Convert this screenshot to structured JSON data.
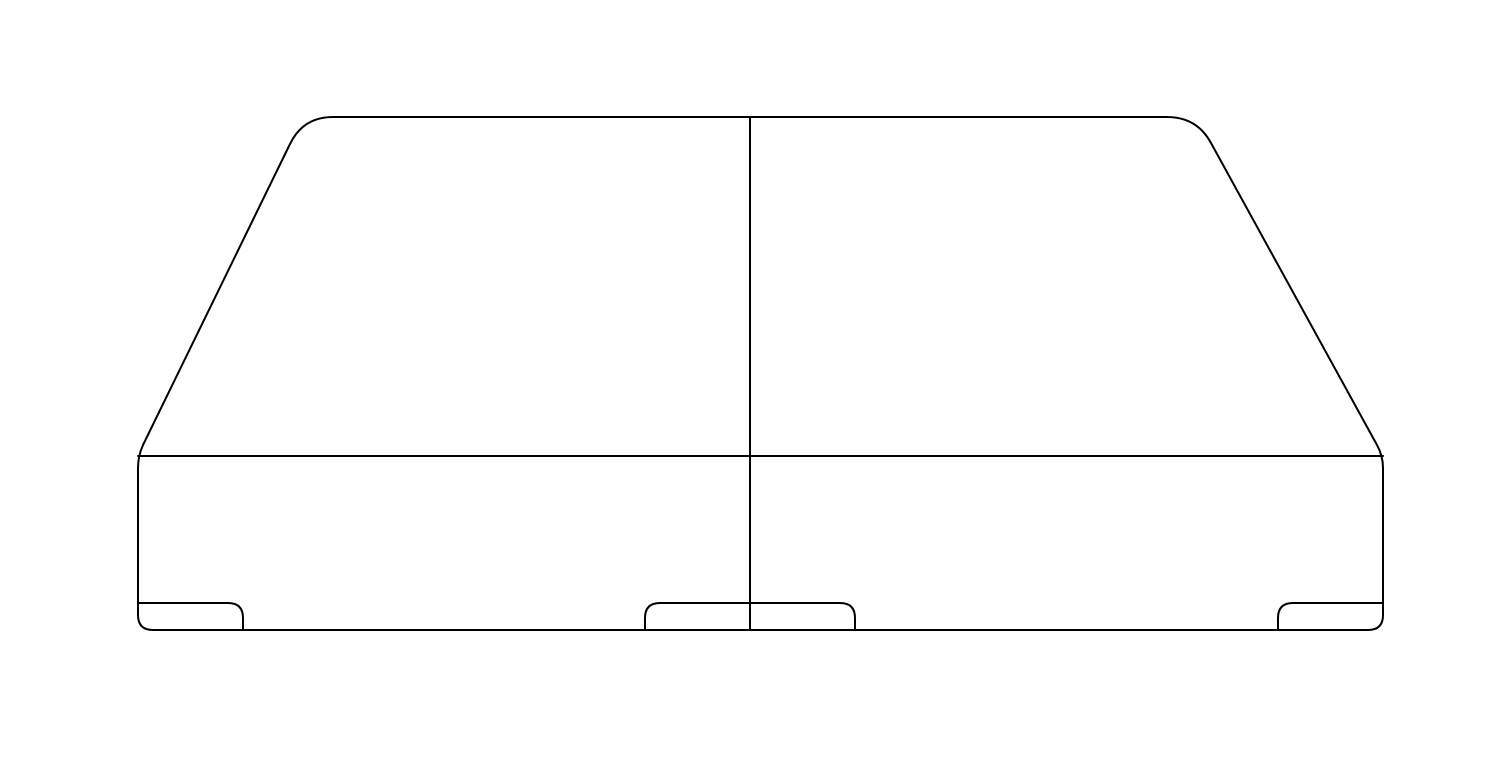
{
  "canvas": {
    "width": 1500,
    "height": 768,
    "background": "#ffffff"
  },
  "drawing": {
    "subject": "split-bed-foundation-outline",
    "stroke_color": "#000000",
    "stroke_width": 2,
    "shapes": [
      {
        "name": "foundation-silhouette",
        "path": "M 333 117 L 1167 117 Q 1197 117 1211 143 L 1377 445 Q 1383 456 1383 468 L 1383 615 Q 1383 630 1368 630 L 153 630 Q 138 630 138 615 L 138 468 Q 138 456 143 445 L 290 144 Q 303 117 333 117 Z"
      },
      {
        "name": "front-top-edge",
        "path": "M 138 456 L 1383 456"
      },
      {
        "name": "center-split-seam",
        "path": "M 750 117 L 750 630"
      },
      {
        "name": "left-glide-foot",
        "path": "M 138 603 L 228 603 Q 243 603 243 618 L 243 630"
      },
      {
        "name": "center-glide-foot",
        "path": "M 645 630 L 645 618 Q 645 603 660 603 L 840 603 Q 855 603 855 618 L 855 630"
      },
      {
        "name": "right-glide-foot",
        "path": "M 1278 630 L 1278 618 Q 1278 603 1293 603 L 1383 603"
      }
    ]
  }
}
